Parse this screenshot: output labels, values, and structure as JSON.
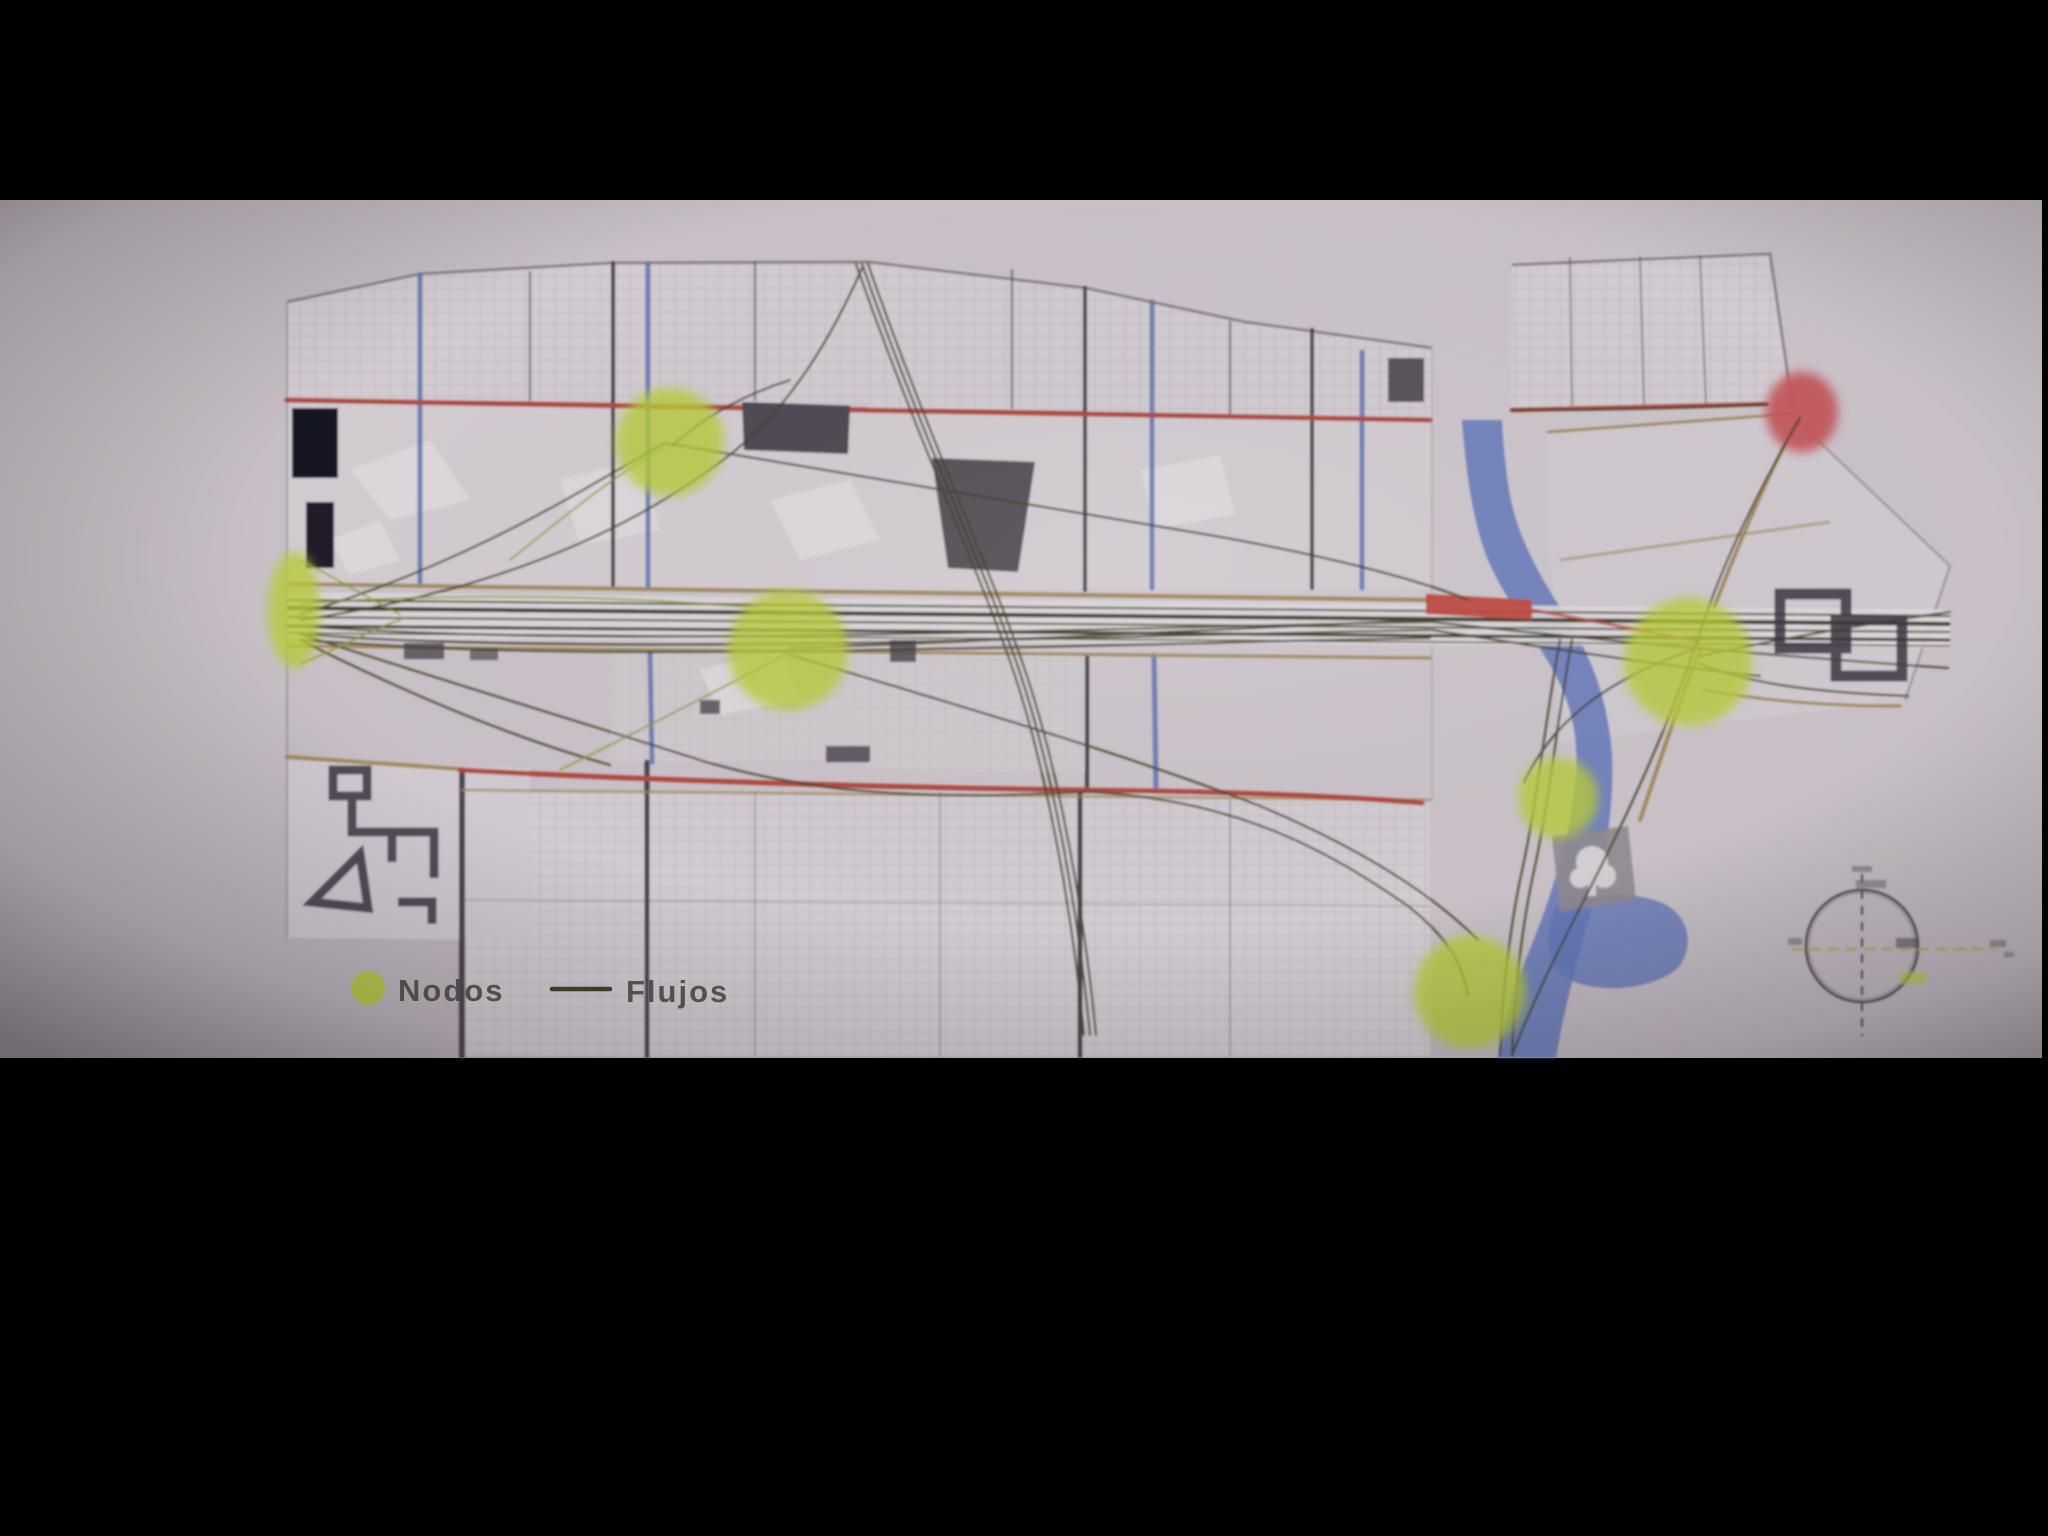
{
  "legend": {
    "nodes_label": "Nodos",
    "flows_label": "Flujos"
  },
  "map": {
    "type": "urban-flow-diagram-photo",
    "nodes": [
      {
        "id": "corridor-west-entry",
        "x": 294,
        "y": 610
      },
      {
        "id": "northwest-junction",
        "x": 670,
        "y": 442
      },
      {
        "id": "central-corridor",
        "x": 788,
        "y": 650
      },
      {
        "id": "east-riverside",
        "x": 1688,
        "y": 662
      },
      {
        "id": "south-river-park",
        "x": 1558,
        "y": 798
      },
      {
        "id": "south-river-mouth",
        "x": 1470,
        "y": 992
      }
    ],
    "red_node": {
      "id": "northeast-terminus",
      "x": 1802,
      "y": 412
    },
    "compass": {
      "present": true,
      "x": 1862,
      "y": 946
    }
  },
  "colors": {
    "letterbox": "#000000",
    "background": "#c6bec4",
    "paper": "#d2ccd2",
    "node_green": "#b7ca37",
    "node_red": "#c2545a",
    "accent_red": "#bf4b41",
    "road_red": "#b04a40",
    "street_blue": "#5a6fae",
    "water_blue": "#6478b8",
    "flow_dark": "#45412b",
    "flow_green": "#8a9a2c",
    "road_tan": "#a28a5e",
    "ink_dark": "#3d3744",
    "text": "#4f4a4a"
  }
}
